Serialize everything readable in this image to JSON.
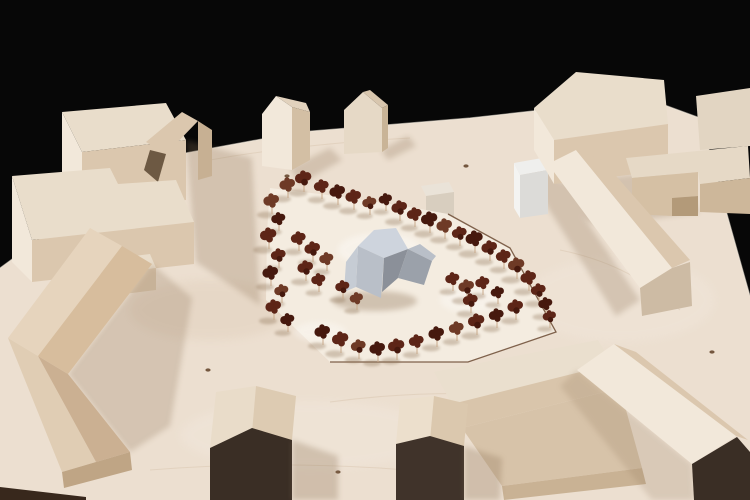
{
  "scene": {
    "kind": "photo-of-architectural-wood-model",
    "colors": {
      "bg": "#070707",
      "board": "#ecdfd0",
      "board-warm": "#e2d1be",
      "board-edge-dark": "#38281c",
      "grain": "#c9b193",
      "knot": "#5f4026",
      "site": "#f4ece0",
      "site-line": "#6b4a33",
      "wood-top": "#e9ddcb",
      "wood-lit": "#f2e8da",
      "wood-mid": "#dbc7ae",
      "wood-dark": "#c7b093",
      "wood-tan": "#d7bd9d",
      "wood-tan-lit": "#e6d4bd",
      "wood-tan-dark": "#c5a582",
      "dark-face": "#3a2e25",
      "dark-face-2": "#40332a",
      "shadow": "#8f7558",
      "prop-1": "#ced4dd",
      "prop-2": "#b9bfc8",
      "prop-3": "#9ba1aa",
      "prop-4": "#8b9099",
      "prop-5": "#c6ccd4",
      "white-box-top": "#efefed",
      "white-box-front": "#dcdbd8",
      "white-box-side": "#f4f4f2",
      "stem": "#c8a98a",
      "tree-1": "#5d2517",
      "tree-2": "#46190e",
      "tree-3": "#6e3a26"
    },
    "tree_count": 51,
    "trees": [
      [
        288,
        196,
        1
      ],
      [
        304,
        190,
        1.05
      ],
      [
        322,
        197,
        0.95
      ],
      [
        338,
        203,
        1
      ],
      [
        354,
        208,
        1
      ],
      [
        370,
        213,
        0.9
      ],
      [
        386,
        209,
        0.85
      ],
      [
        400,
        219,
        1
      ],
      [
        415,
        225,
        0.95
      ],
      [
        430,
        231,
        1.05
      ],
      [
        445,
        237,
        1
      ],
      [
        460,
        244,
        0.95
      ],
      [
        475,
        251,
        1.1
      ],
      [
        490,
        259,
        1
      ],
      [
        504,
        267,
        0.95
      ],
      [
        517,
        277,
        1.05
      ],
      [
        529,
        289,
        1
      ],
      [
        539,
        301,
        0.95
      ],
      [
        546,
        314,
        0.9
      ],
      [
        550,
        326,
        0.85
      ],
      [
        272,
        212,
        1
      ],
      [
        279,
        229,
        0.9
      ],
      [
        269,
        247,
        1.05
      ],
      [
        279,
        266,
        0.95
      ],
      [
        271,
        284,
        1
      ],
      [
        282,
        301,
        0.9
      ],
      [
        274,
        318,
        1
      ],
      [
        288,
        330,
        0.9
      ],
      [
        299,
        249,
        0.95
      ],
      [
        313,
        260,
        1
      ],
      [
        327,
        269,
        0.9
      ],
      [
        306,
        279,
        1
      ],
      [
        319,
        290,
        0.9
      ],
      [
        323,
        343,
        1
      ],
      [
        341,
        351,
        1.05
      ],
      [
        359,
        357,
        0.95
      ],
      [
        378,
        360,
        1
      ],
      [
        397,
        358,
        1.05
      ],
      [
        417,
        352,
        0.95
      ],
      [
        437,
        345,
        1
      ],
      [
        457,
        339,
        0.95
      ],
      [
        477,
        333,
        1.05
      ],
      [
        497,
        326,
        0.95
      ],
      [
        516,
        318,
        1
      ],
      [
        453,
        289,
        0.9
      ],
      [
        467,
        298,
        1
      ],
      [
        483,
        293,
        0.9
      ],
      [
        471,
        311,
        0.95
      ],
      [
        498,
        302,
        0.85
      ],
      [
        343,
        297,
        0.9
      ],
      [
        357,
        308,
        0.85
      ]
    ],
    "knots": [
      [
        287,
        176
      ],
      [
        466,
        166
      ],
      [
        208,
        370
      ],
      [
        97,
        416
      ],
      [
        338,
        472
      ],
      [
        712,
        352
      ],
      [
        540,
        491
      ]
    ]
  }
}
